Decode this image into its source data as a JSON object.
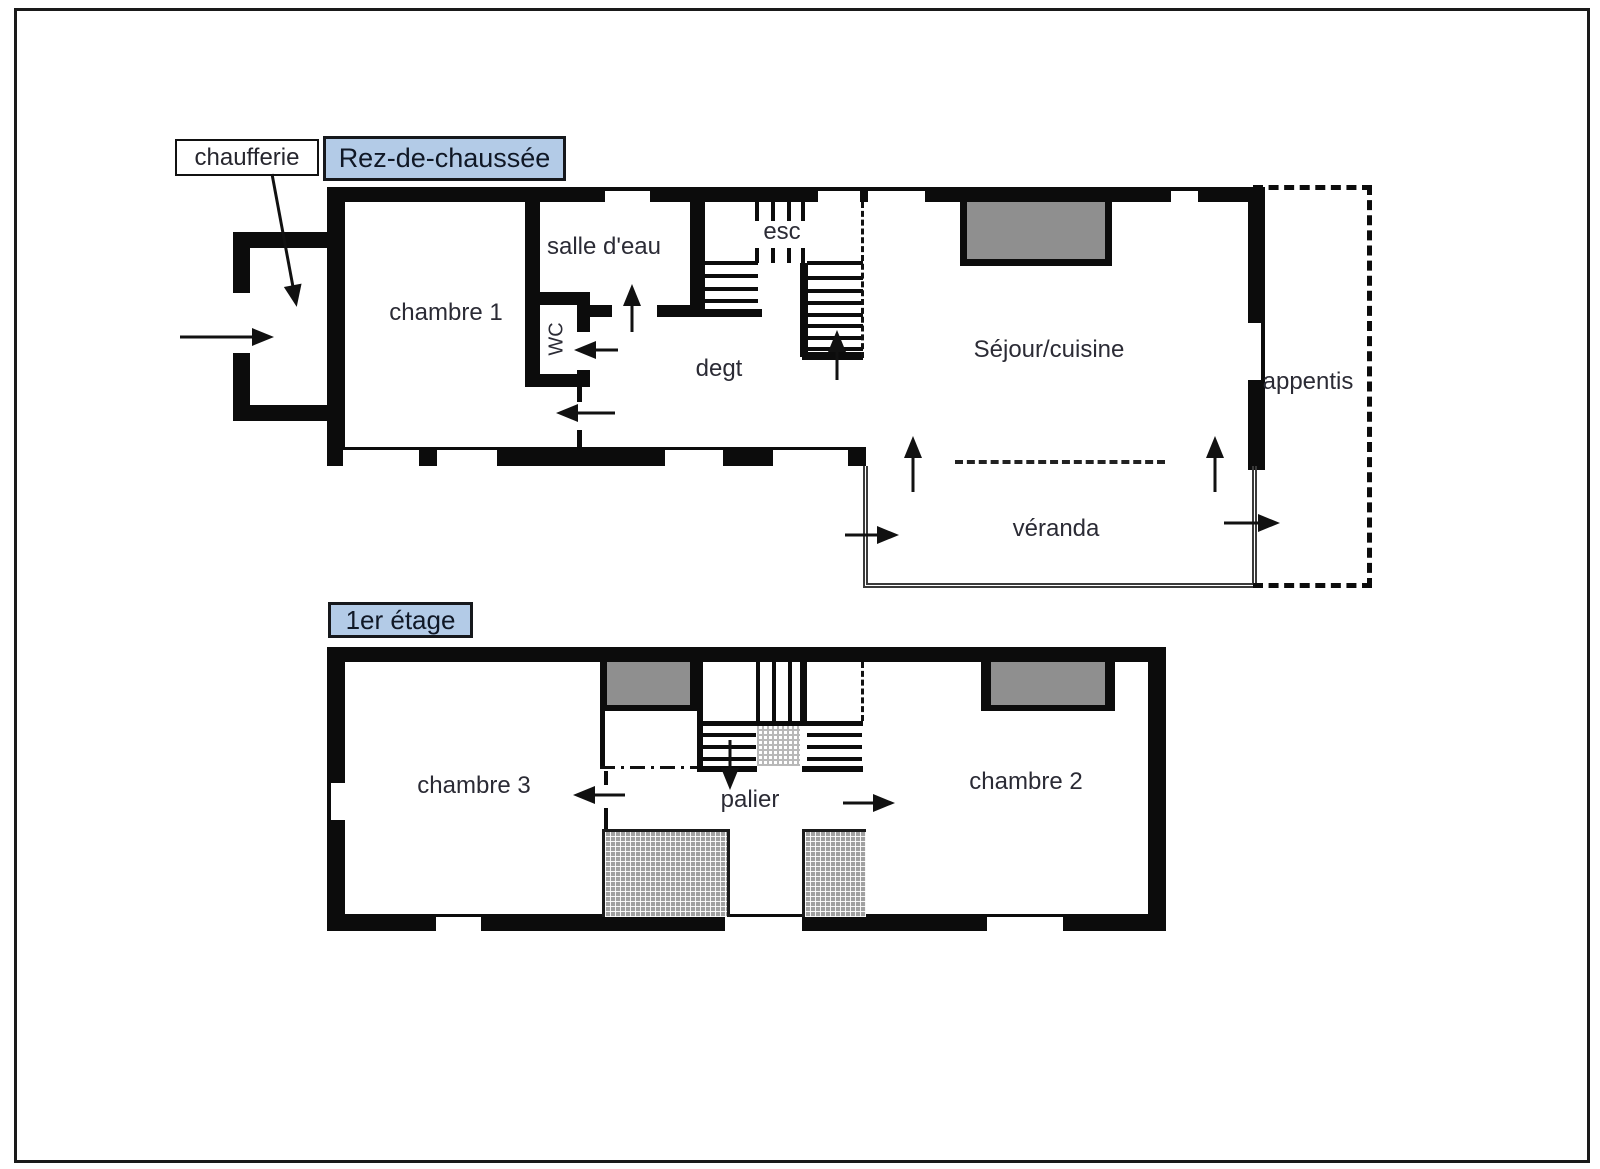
{
  "palette": {
    "wall": "#0c0c0c",
    "label_box_bg": "#b3cbe7",
    "label_box_border": "#16181c",
    "chimney_fill": "#8f8f8f",
    "text": "#2b2b35",
    "page_bg": "#ffffff"
  },
  "floors": [
    {
      "title": "Rez-de-chaussée",
      "rooms": [
        {
          "name": "chambre 1"
        },
        {
          "name": "salle d'eau"
        },
        {
          "name": "WC"
        },
        {
          "name": "esc"
        },
        {
          "name": "degt"
        },
        {
          "name": "Séjour/cuisine"
        },
        {
          "name": "véranda"
        },
        {
          "name": "appentis"
        },
        {
          "name": "chaufferie"
        }
      ]
    },
    {
      "title": "1er étage",
      "rooms": [
        {
          "name": "chambre 3"
        },
        {
          "name": "palier"
        },
        {
          "name": "chambre 2"
        }
      ]
    }
  ]
}
